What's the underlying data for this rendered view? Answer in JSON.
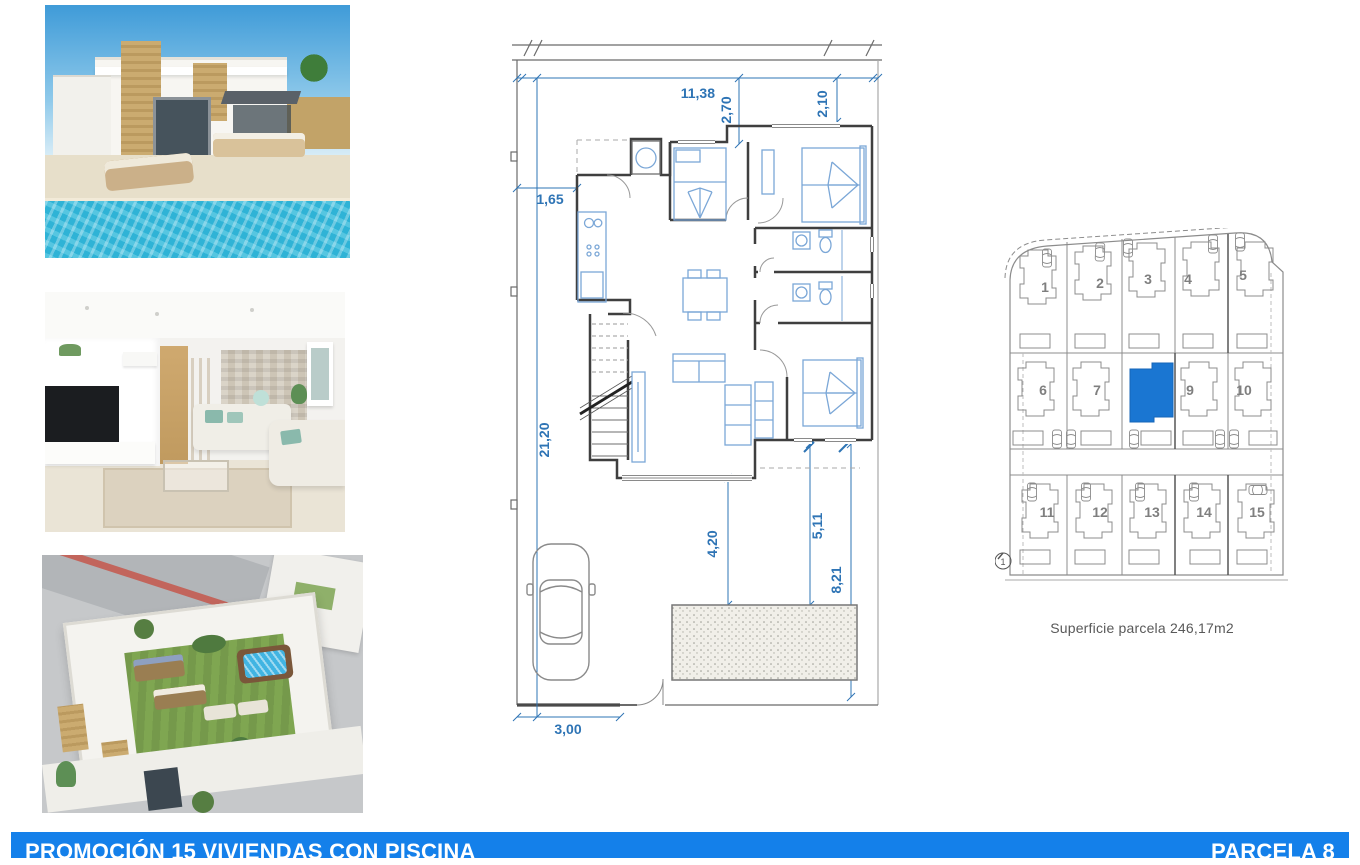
{
  "photos": [
    {
      "name": "villa-exterior-with-pool"
    },
    {
      "name": "living-room-interior"
    },
    {
      "name": "rooftop-solarium-aerial"
    }
  ],
  "floor_plan": {
    "dims": {
      "top_width": "11,38",
      "top_inset_a": "2,70",
      "top_inset_b": "2,10",
      "left_inset": "1,65",
      "plot_depth": "21,20",
      "porch_to_pool": "4,20",
      "window_to_pool": "5,11",
      "window_to_boundary": "8,21",
      "pool_size": "6,00x 2,50",
      "gate_width": "3,00"
    },
    "accent_color": "#2e74b5"
  },
  "site_plan": {
    "rows": [
      [
        "1",
        "2",
        "3",
        "4",
        "5"
      ],
      [
        "6",
        "7",
        "9",
        "10"
      ],
      [
        "11",
        "12",
        "13",
        "14",
        "15"
      ]
    ],
    "highlighted_parcel": "8",
    "highlight_color": "#1a76d2",
    "compass": "1",
    "caption": "Superficie parcela 246,17m2"
  },
  "footer": {
    "title": "PROMOCIÓN 15 VIVIENDAS CON PISCINA",
    "parcel": "PARCELA 8",
    "bar_color": "#1480ea"
  }
}
